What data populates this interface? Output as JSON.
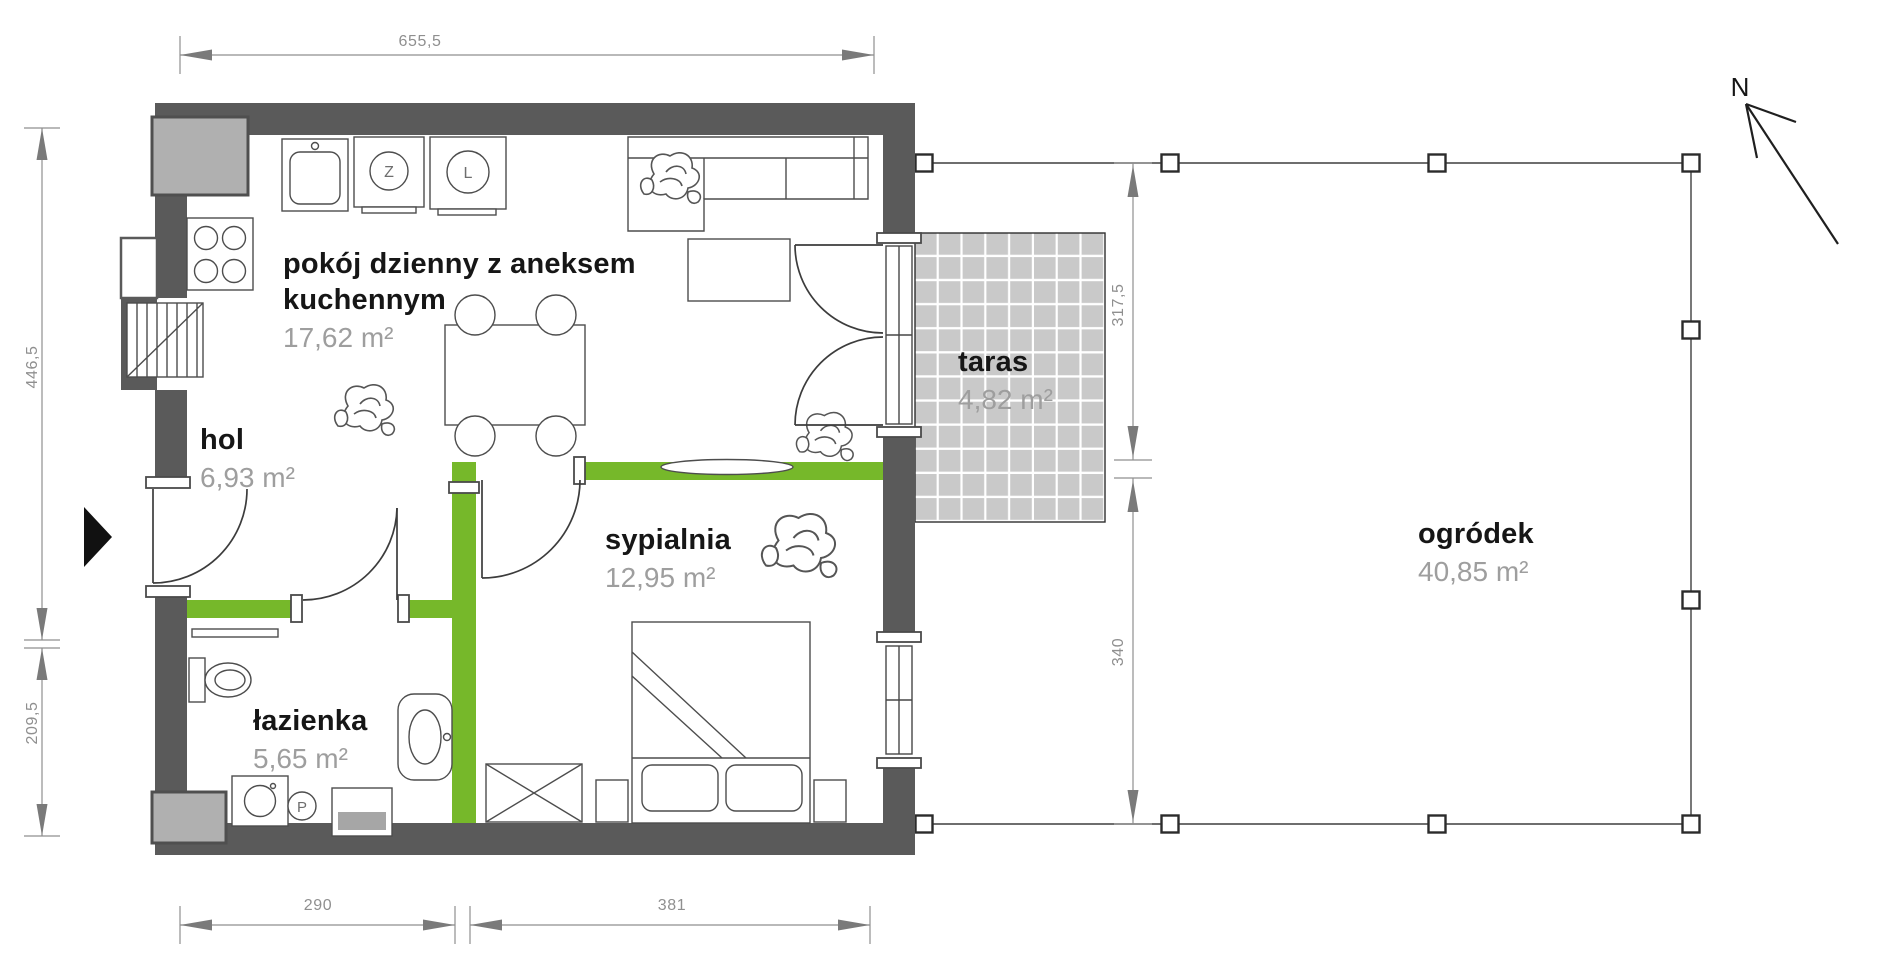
{
  "rooms": {
    "living": {
      "name": "pokój dzienny z aneksem kuchennym",
      "area": "17,62 m²"
    },
    "hall": {
      "name": "hol",
      "area": "6,93 m²"
    },
    "bedroom": {
      "name": "sypialnia",
      "area": "12,95 m²"
    },
    "bathroom": {
      "name": "łazienka",
      "area": "5,65 m²"
    },
    "terrace": {
      "name": "taras",
      "area": "4,82 m²"
    },
    "garden": {
      "name": "ogródek",
      "area": "40,85 m²"
    }
  },
  "dimensions_cm": {
    "top_width": "655,5",
    "left_upper": "446,5",
    "left_lower": "209,5",
    "bottom_bathroom": "290",
    "bottom_bedroom": "381",
    "garden_upper": "317,5",
    "garden_lower": "340"
  },
  "appliance_marks": {
    "dishwasher": "Z",
    "fridge": "L",
    "washing_machine": "P"
  },
  "compass": {
    "north_label": "N"
  },
  "colors": {
    "wall_gray": "#5a5a5a",
    "accent_wall_green": "#76b82a",
    "terrace_tile_gray": "#c9c9c9",
    "dimension_gray": "#8f8f8f",
    "area_text_gray": "#9e9e9e",
    "label_black": "#161616"
  }
}
